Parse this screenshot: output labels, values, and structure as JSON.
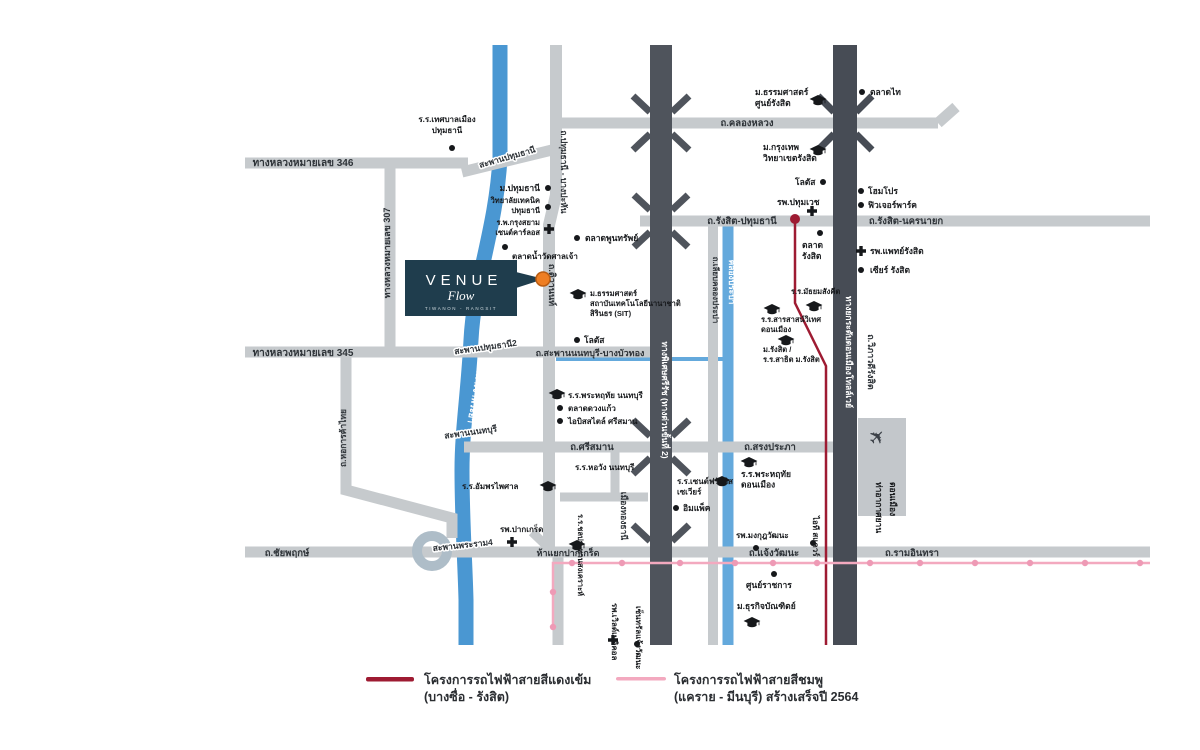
{
  "project": {
    "name": "VENUE",
    "sub": "Flow",
    "tagline": "TIWANON - RANGSIT"
  },
  "colors": {
    "road_light": "#c6cacd",
    "road_dark": "#4f545c",
    "tollway": "#474c55",
    "river": "#4a97d2",
    "canal": "#64a9dc",
    "red_line": "#9e1b32",
    "pink_line": "#f3a9bf",
    "pink_station": "#ee9ab5",
    "venue_box": "#1f3d4d",
    "venue_pin": "#ee7e23"
  },
  "legend": [
    {
      "label": "โครงการรถไฟฟ้าสายสีแดงเข้ม",
      "sublabel": "(บางซื่อ - รังสิต)",
      "color": "#9e1b32"
    },
    {
      "label": "โครงการรถไฟฟ้าสายสีชมพู",
      "sublabel": "(แคราย - มีนบุรี) สร้างเสร็จปี 2564",
      "color": "#f3a9bf"
    }
  ],
  "map": {
    "road_labels": [
      {
        "t": "ทางหลวงหมายเลข 346",
        "x": 303,
        "y": 166,
        "size": 10
      },
      {
        "t": "สะพานปทุมธานี",
        "x": 508,
        "y": 160,
        "rot": -16,
        "size": 8.5,
        "halo": true
      },
      {
        "t": "ถ.ปทุมธานี - บางปะหัน",
        "x": 561,
        "y": 172,
        "rot": 90,
        "size": 8.5
      },
      {
        "t": "ถ.คลองหลวง",
        "x": 747,
        "y": 126,
        "size": 9.5
      },
      {
        "t": "ถ.รังสิต-ปทุมธานี",
        "x": 742,
        "y": 224,
        "size": 9.5
      },
      {
        "t": "ถ.รังสิต-นครนายก",
        "x": 906,
        "y": 224,
        "size": 9.5
      },
      {
        "t": "ทางหลวงหมายเลข 307",
        "x": 390,
        "y": 253,
        "rot": -90,
        "size": 9
      },
      {
        "t": "ทางหลวงหมายเลข 345",
        "x": 303,
        "y": 356,
        "size": 10
      },
      {
        "t": "สะพานปทุมธานี2",
        "x": 486,
        "y": 350,
        "rot": -8,
        "size": 8.5,
        "halo": true
      },
      {
        "t": "ถ.สะพานนนทบุรี-บางบัวทอง",
        "x": 590,
        "y": 356,
        "size": 9
      },
      {
        "t": "ถ.ติวานนท์",
        "x": 549,
        "y": 285,
        "rot": 90,
        "size": 9
      },
      {
        "t": "ถ.หอการค้าไทย",
        "x": 346,
        "y": 438,
        "rot": -90,
        "size": 8.5
      },
      {
        "t": "สะพานนนทบุรี",
        "x": 471,
        "y": 435,
        "rot": -8,
        "size": 8.5,
        "halo": true
      },
      {
        "t": "ถ.ศรีสมาน",
        "x": 592,
        "y": 450,
        "size": 9.5
      },
      {
        "t": "ถ.สรงประภา",
        "x": 770,
        "y": 450,
        "size": 9.5
      },
      {
        "t": "ถ.ชัยพฤกษ์",
        "x": 287,
        "y": 556,
        "size": 9.5
      },
      {
        "t": "สะพานพระราม4",
        "x": 463,
        "y": 548,
        "rot": -6,
        "size": 8.5,
        "halo": true
      },
      {
        "t": "ห้าแยกปากเกร็ด",
        "x": 568,
        "y": 556,
        "size": 9
      },
      {
        "t": "ถ.แจ้งวัฒนะ",
        "x": 774,
        "y": 556,
        "size": 9.5
      },
      {
        "t": "ถ.รามอินทรา",
        "x": 912,
        "y": 556,
        "size": 9.5
      },
      {
        "t": "ถ.เลียบคลองประปา",
        "x": 713,
        "y": 290,
        "rot": 90,
        "size": 8
      },
      {
        "t": "คลองประปา",
        "x": 729,
        "y": 282,
        "rot": 90,
        "size": 8.5,
        "white": true
      },
      {
        "t": "แม่น้ำเจ้าพระยา",
        "x": 473,
        "y": 392,
        "rot": 100,
        "size": 9,
        "white": true
      },
      {
        "t": "ทางพิเศษศรีรัช (ทางด่วนขั้นที่ 2)",
        "x": 662,
        "y": 400,
        "rot": 90,
        "size": 8.5,
        "white": true
      },
      {
        "t": "ทางยกระดับดอนเมืองโทลล์เวย์",
        "x": 846,
        "y": 352,
        "rot": 90,
        "size": 8.5,
        "white": true
      },
      {
        "t": "ถ.วิภาวดีรังสิต",
        "x": 868,
        "y": 362,
        "rot": 90,
        "size": 9
      },
      {
        "t": "เมืองทองธานี",
        "x": 621,
        "y": 516,
        "rot": 90,
        "size": 8.5
      }
    ],
    "landmarks": [
      {
        "lines": [
          "ร.ร.เทศบาลเมือง",
          "ปทุมธานี"
        ],
        "x": 447,
        "y": 122,
        "lh": 11,
        "align": "middle",
        "size": 8,
        "marker": {
          "type": "dot",
          "x": 452,
          "y": 148
        }
      },
      {
        "lines": [
          "ม.ปทุมธานี"
        ],
        "x": 540,
        "y": 191,
        "align": "end",
        "size": 8.5,
        "marker": {
          "type": "dot",
          "x": 548,
          "y": 188
        }
      },
      {
        "lines": [
          "วิทยาลัยเทคนิค",
          "ปทุมธานี"
        ],
        "x": 540,
        "y": 203,
        "lh": 10,
        "align": "end",
        "size": 7.5,
        "marker": {
          "type": "dot",
          "x": 548,
          "y": 207
        }
      },
      {
        "lines": [
          "ร.พ.กรุงสยาม",
          "เซนต์คาร์ลอส"
        ],
        "x": 540,
        "y": 225,
        "lh": 10,
        "align": "end",
        "size": 7.5,
        "marker": {
          "type": "cross",
          "x": 549,
          "y": 229
        }
      },
      {
        "lines": [
          "ตลาดน้ำวัดศาลเจ้า"
        ],
        "x": 512,
        "y": 259,
        "size": 8,
        "marker": {
          "type": "dot",
          "x": 505,
          "y": 247
        }
      },
      {
        "lines": [
          "ตลาดพูนทรัพย์"
        ],
        "x": 585,
        "y": 241,
        "size": 8.5,
        "marker": {
          "type": "dot",
          "x": 577,
          "y": 238
        }
      },
      {
        "lines": [
          "ม.ธรรมศาสตร์",
          "สถาบันเทคโนโลยีนานาชาติ",
          "สิรินธร (SIT)"
        ],
        "x": 590,
        "y": 296,
        "lh": 10,
        "size": 7.5,
        "marker": {
          "type": "cap",
          "x": 578,
          "y": 294
        }
      },
      {
        "lines": [
          "โลตัส"
        ],
        "x": 584,
        "y": 343,
        "size": 8.5,
        "marker": {
          "type": "dot",
          "x": 577,
          "y": 340
        }
      },
      {
        "lines": [
          "ร.ร.พระหฤทัย นนทบุรี"
        ],
        "x": 568,
        "y": 398,
        "size": 8,
        "marker": {
          "type": "cap",
          "x": 557,
          "y": 394
        }
      },
      {
        "lines": [
          "ตลาดดวงแก้ว"
        ],
        "x": 568,
        "y": 411,
        "size": 8,
        "marker": {
          "type": "dot",
          "x": 560,
          "y": 408
        }
      },
      {
        "lines": [
          "ไอบิสสไตล์ ศรีสมาน"
        ],
        "x": 568,
        "y": 424,
        "size": 8,
        "marker": {
          "type": "dot",
          "x": 560,
          "y": 421
        }
      },
      {
        "lines": [
          "ร.ร.หอวัง นนทบุรี"
        ],
        "x": 575,
        "y": 470,
        "size": 8
      },
      {
        "lines": [
          "ร.ร.อัมพรไพศาล"
        ],
        "x": 462,
        "y": 489,
        "size": 8,
        "marker": {
          "type": "cap",
          "x": 548,
          "y": 486
        }
      },
      {
        "lines": [
          "รพ.ปากเกร็ด"
        ],
        "x": 500,
        "y": 532,
        "size": 8,
        "marker": {
          "type": "cross",
          "x": 512,
          "y": 542
        }
      },
      {
        "lines": [
          "ร.ร.ชลประทานสงเคราะห์"
        ],
        "x": 578,
        "y": 514,
        "rot": 90,
        "size": 7.5,
        "marker": {
          "type": "cap",
          "x": 577,
          "y": 545
        }
      },
      {
        "lines": [
          "ร.ร.เซนต์ฟรังซิส",
          "เซเวียร์"
        ],
        "x": 677,
        "y": 484,
        "lh": 10.5,
        "size": 8,
        "marker": {
          "type": "cap",
          "x": 722,
          "y": 481
        }
      },
      {
        "lines": [
          "อิมแพ็ค"
        ],
        "x": 683,
        "y": 511,
        "size": 8.5,
        "marker": {
          "type": "dot",
          "x": 676,
          "y": 508
        }
      },
      {
        "lines": [
          "รพ.เวิลด์เมดิคอล"
        ],
        "x": 612,
        "y": 603,
        "rot": 90,
        "size": 8,
        "marker": {
          "type": "cross",
          "x": 613,
          "y": 640
        }
      },
      {
        "lines": [
          "เซ็นทรัลแจ้งวัฒนะ"
        ],
        "x": 636,
        "y": 606,
        "rot": 90,
        "size": 8,
        "marker": {
          "type": "dot",
          "x": 637,
          "y": 644
        }
      },
      {
        "lines": [
          "ศูนย์ราชการ"
        ],
        "x": 746,
        "y": 588,
        "size": 8.5,
        "marker": {
          "type": "dot",
          "x": 774,
          "y": 574
        }
      },
      {
        "lines": [
          "ม.ธุรกิจบัณฑิตย์"
        ],
        "x": 737,
        "y": 609,
        "size": 8.5,
        "marker": {
          "type": "cap",
          "x": 752,
          "y": 622
        }
      },
      {
        "lines": [
          "รพ.มงกุฎวัฒนะ"
        ],
        "x": 736,
        "y": 538,
        "size": 8,
        "marker": {
          "type": "dot",
          "x": 756,
          "y": 548
        }
      },
      {
        "lines": [
          "ไอที สแควร์"
        ],
        "x": 813,
        "y": 516,
        "rot": 90,
        "size": 8,
        "marker": {
          "type": "dot",
          "x": 813,
          "y": 543
        }
      },
      {
        "lines": [
          "ร.ร.พระหฤทัย",
          "ดอนเมือง"
        ],
        "x": 741,
        "y": 477,
        "lh": 10.5,
        "size": 8.5,
        "marker": {
          "type": "cap",
          "x": 749,
          "y": 462
        }
      },
      {
        "lines": [
          "ท่าอากาศยาน"
        ],
        "x": 876,
        "y": 482,
        "rot": 90,
        "size": 8.5,
        "gray": true
      },
      {
        "lines": [
          "ดอนเมือง"
        ],
        "x": 890,
        "y": 482,
        "rot": 90,
        "size": 8.5,
        "gray": true,
        "marker": {
          "type": "plane",
          "x": 882,
          "y": 442
        }
      },
      {
        "lines": [
          "ม.ธรรมศาสตร์",
          "ศูนย์รังสิต"
        ],
        "x": 755,
        "y": 95,
        "lh": 11,
        "size": 8.5,
        "marker": {
          "type": "cap",
          "x": 818,
          "y": 100
        }
      },
      {
        "lines": [
          "ตลาดไท"
        ],
        "x": 870,
        "y": 95,
        "size": 8.5,
        "marker": {
          "type": "dot",
          "x": 862,
          "y": 92
        }
      },
      {
        "lines": [
          "ม.กรุงเทพ",
          "วิทยาเขตรังสิต"
        ],
        "x": 763,
        "y": 150,
        "lh": 11,
        "size": 8.5,
        "marker": {
          "type": "cap",
          "x": 818,
          "y": 150
        }
      },
      {
        "lines": [
          "โลตัส"
        ],
        "x": 795,
        "y": 185,
        "size": 8.5,
        "marker": {
          "type": "dot",
          "x": 823,
          "y": 182
        }
      },
      {
        "lines": [
          "รพ.ปทุมเวช"
        ],
        "x": 777,
        "y": 205,
        "size": 8.5,
        "marker": {
          "type": "cross",
          "x": 812,
          "y": 211
        }
      },
      {
        "lines": [
          "โฮมโปร"
        ],
        "x": 868,
        "y": 194,
        "size": 8.5,
        "marker": {
          "type": "dot",
          "x": 861,
          "y": 191
        }
      },
      {
        "lines": [
          "ฟิวเจอร์พาร์ค"
        ],
        "x": 868,
        "y": 208,
        "size": 8.5,
        "marker": {
          "type": "dot",
          "x": 861,
          "y": 205
        }
      },
      {
        "lines": [
          "รพ.แพทย์รังสิต"
        ],
        "x": 870,
        "y": 254,
        "size": 8.5,
        "marker": {
          "type": "cross",
          "x": 861,
          "y": 251
        }
      },
      {
        "lines": [
          "เซียร์ รังสิต"
        ],
        "x": 870,
        "y": 273,
        "size": 8.5,
        "marker": {
          "type": "dot",
          "x": 861,
          "y": 270
        }
      },
      {
        "lines": [
          "ตลาด",
          "รังสิต"
        ],
        "x": 802,
        "y": 248,
        "lh": 11,
        "size": 8.5,
        "marker": {
          "type": "dot",
          "x": 820,
          "y": 233
        }
      },
      {
        "lines": [
          "ร.ร.มัธยมสังคีต"
        ],
        "x": 791,
        "y": 294,
        "size": 7.5,
        "marker": {
          "type": "cap",
          "x": 814,
          "y": 306
        }
      },
      {
        "lines": [
          "ร.ร.สารสาสน์วิเทศ",
          "ดอนเมือง"
        ],
        "x": 761,
        "y": 322,
        "lh": 10,
        "size": 7.5,
        "marker": {
          "type": "cap",
          "x": 772,
          "y": 309
        }
      },
      {
        "lines": [
          "ม.รังสิต /",
          "ร.ร.สาธิต ม.รังสิต"
        ],
        "x": 763,
        "y": 352,
        "lh": 10,
        "size": 7.5,
        "marker": {
          "type": "cap",
          "x": 786,
          "y": 340
        }
      }
    ],
    "rail": {
      "red": {
        "path": "M795 220 L795 303 L826 366 L826 645",
        "origin": [
          795,
          219
        ]
      },
      "pink": {
        "path": "M553 628 L553 563 L1150 563",
        "stations": [
          [
            553,
            627
          ],
          [
            553,
            592
          ],
          [
            572,
            563
          ],
          [
            622,
            563
          ],
          [
            680,
            563
          ],
          [
            735,
            563
          ],
          [
            773,
            563
          ],
          [
            817,
            563
          ],
          [
            870,
            563
          ],
          [
            920,
            563
          ],
          [
            975,
            563
          ],
          [
            1030,
            563
          ],
          [
            1085,
            563
          ],
          [
            1140,
            563
          ]
        ]
      }
    }
  }
}
